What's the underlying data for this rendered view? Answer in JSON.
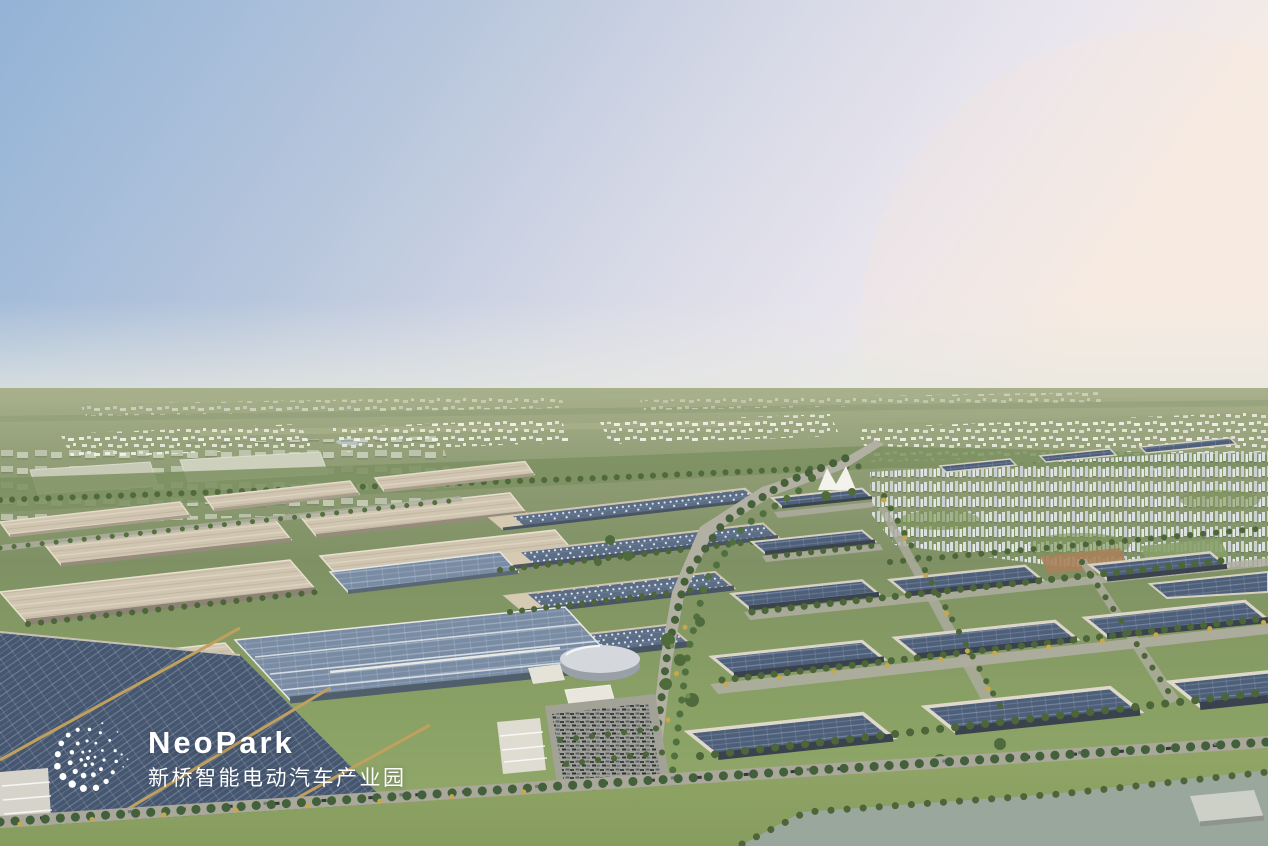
{
  "logo": {
    "name": "NeoPark",
    "subtitle": "新桥智能电动汽车产业园",
    "mark": "dotted-sphere",
    "color": "#ffffff"
  },
  "scene": {
    "description_elements": [
      "sky",
      "distant-plain",
      "town-band",
      "greenbelt",
      "factory-campus",
      "solar-warehouse-district",
      "central-boulevard",
      "residential-district",
      "parking-lot",
      "round-tank",
      "tent-landmark",
      "front-lawn",
      "pond"
    ],
    "palette": {
      "sky_blue": "#93b3d6",
      "sky_pink": "#f6ece4",
      "plain_green": "#9aa482",
      "park_green": "#7e9362",
      "lawn_green": "#93a769",
      "solar_dark": "#4e5f79",
      "solar_mid": "#7a8ca3",
      "roof_beige": "#cfc5b0",
      "concrete": "#d7d1c3",
      "road_gray": "#b2b0a3",
      "water_gray": "#9aa79c",
      "tree_green": "#4c6539",
      "tree_autumn": "#c9a74f",
      "gold_beam": "#bfa05c"
    }
  }
}
